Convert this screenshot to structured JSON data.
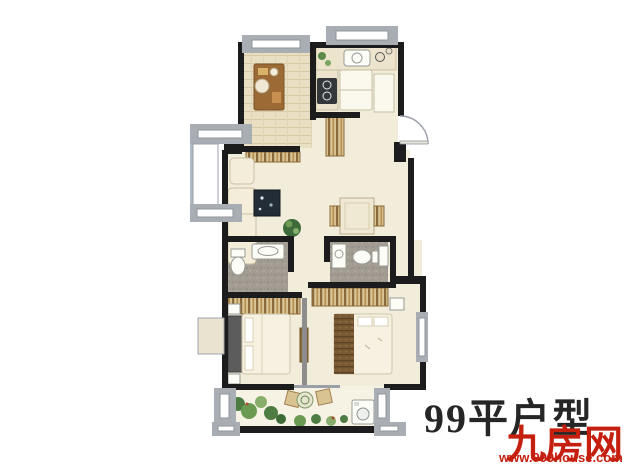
{
  "caption": {
    "title": "99平户型"
  },
  "watermark": {
    "brand": "九房网",
    "url": "www.999house.com"
  },
  "palette": {
    "background": "#ffffff",
    "wall": "#1c1c1c",
    "window_frame": "#a8aeb4",
    "floor": "#f2ecda",
    "wood_floor": "#e9dfc2",
    "bath_floor": "#a29c92",
    "furniture_tan": "#d9c392",
    "furniture_brown": "#9c6b35",
    "rug_navy": "#232d38",
    "plant_green": "#4e7d43",
    "brand_red": "#c5200f",
    "title_color": "#262626"
  }
}
